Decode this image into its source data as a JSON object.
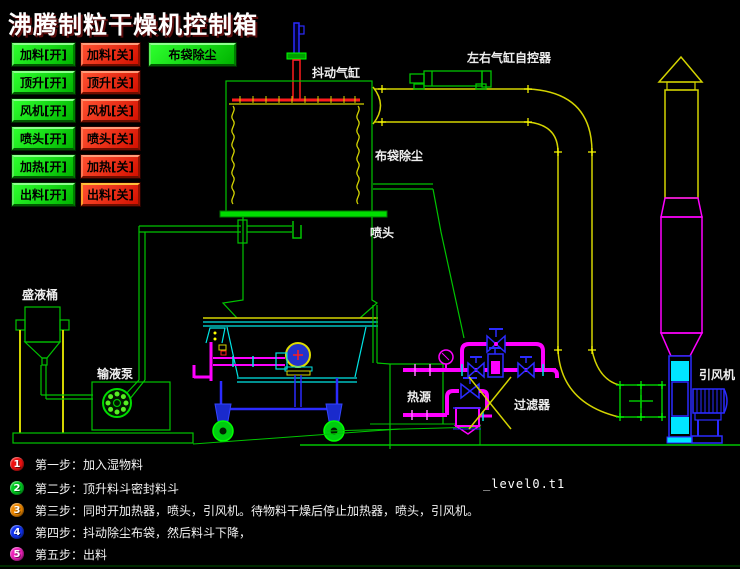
{
  "title": "沸腾制粒干燥机控制箱",
  "buttons": {
    "bag_dust": "布袋除尘",
    "on": [
      "加料[开]",
      "顶升[开]",
      "风机[开]",
      "喷头[开]",
      "加热[开]",
      "出料[开]"
    ],
    "off": [
      "加料[关]",
      "顶升[关]",
      "风机[关]",
      "喷头[关]",
      "加热[关]",
      "出料[关]"
    ]
  },
  "diagram_labels": {
    "shake_cylinder": "抖动气缸",
    "lr_cylinder_controller": "左右气缸自控器",
    "bag_dust": "布袋除尘",
    "nozzle": "喷头",
    "liquid_tank": "盛液桶",
    "liquid_pump": "输液泵",
    "heat_source": "热源",
    "filter": "过滤器",
    "induced_fan": "引风机"
  },
  "steps": [
    {
      "num": "1",
      "text": "第一步：加入湿物料",
      "color": "#ee1111"
    },
    {
      "num": "2",
      "text": "第二步：顶升料斗密封料斗",
      "color": "#00cc22"
    },
    {
      "num": "3",
      "text": "第三步：同时开加热器，喷头，引风机。待物料干燥后停止加热器，喷头，引风机。",
      "color": "#ee8800"
    },
    {
      "num": "4",
      "text": "第四步：抖动除尘布袋，然后料斗下降，",
      "color": "#1133ee"
    },
    {
      "num": "5",
      "text": "第五步：出料",
      "color": "#ee22bb"
    }
  ],
  "footer": {
    "flash_var": "_level0.t1"
  },
  "colors": {
    "background": "#000000",
    "button_on": "#00cc00",
    "button_off": "#dd1100",
    "cad_green": "#00c400",
    "cad_yellow": "#d4d400",
    "cad_cyan": "#00e5e5",
    "cad_blue": "#2b2bff",
    "cad_magenta": "#ff00ff",
    "cad_red": "#ff1c1c"
  }
}
